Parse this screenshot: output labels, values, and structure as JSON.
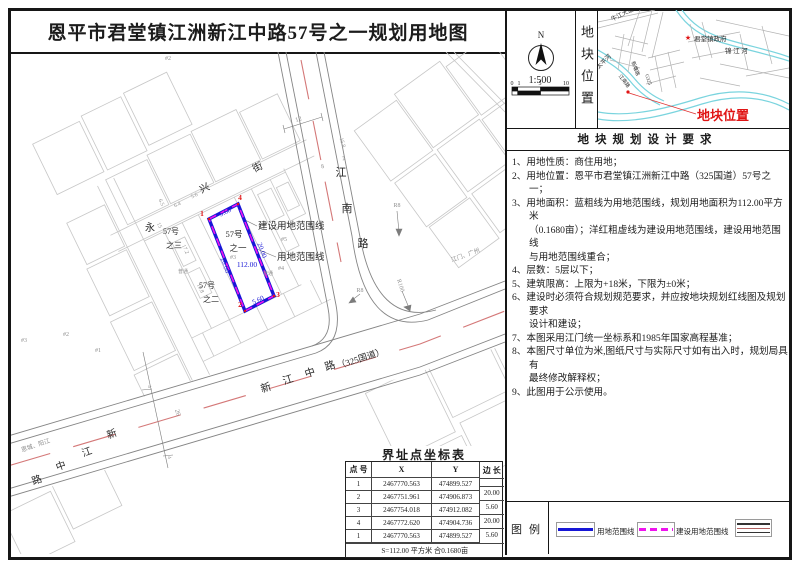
{
  "sheet": {
    "title": "恩平市君堂镇江洲新江中路57号之一规划用地图"
  },
  "compass": {
    "north_label": "N",
    "scale_text": "1:500",
    "scale_ticks": [
      "0",
      "1",
      "5",
      "10"
    ]
  },
  "location_panel": {
    "side_label": "地块位置"
  },
  "requirements": {
    "header": "地块规划设计要求",
    "items": [
      "1、用地性质：商住用地；",
      "2、用地位置：恩平市君堂镇江洲新江中路（325国道）57号之一；",
      "3、用地面积：蓝粗线为用地范围线，规划用地面积为112.00平方米\n（0.1680亩）；洋红粗虚线为建设用地范围线，建设用地范围线\n与用地范围线重合；",
      "4、层数：5层以下；",
      "5、建筑限高：上限为+18米，下限为±0米；",
      "6、建设时必须符合规划规范要求，并应按地块规划红线图及规划要求\n设计和建设；",
      "7、本图采用江门统一坐标系和1985年国家高程基准；",
      "8、本图尺寸单位为米,图纸尺寸与实际尺寸如有出入时，规划局具有\n最终修改解释权；",
      "9、此图用于公示使用。"
    ]
  },
  "legend": {
    "header": "图例",
    "items": [
      {
        "label": "用地范围线"
      },
      {
        "label": "建设用地范围线"
      },
      {
        "label": ""
      }
    ]
  },
  "coord_table": {
    "title": "界址点坐标表",
    "columns": [
      "点 号",
      "X",
      "Y",
      "边 长"
    ],
    "rows": [
      [
        "1",
        "2467770.563",
        "474899.527"
      ],
      [
        "2",
        "2467751.961",
        "474906.873"
      ],
      [
        "3",
        "2467754.018",
        "474912.082"
      ],
      [
        "4",
        "2467772.620",
        "474904.736"
      ],
      [
        "1",
        "2467770.563",
        "474899.527"
      ]
    ],
    "edge_lengths": [
      "20.00",
      "5.60",
      "20.00",
      "5.60"
    ],
    "footer": "S=112.00 平方米 合0.1680亩"
  },
  "colors": {
    "blue": "#1717d6",
    "magenta": "#ee13ee",
    "red": "#e01414",
    "gray": "#8f8f8f",
    "ink": "#2a2a2a",
    "river": "#7ad4de"
  },
  "map": {
    "labels": [
      {
        "t": "兴",
        "x": 206,
        "y": 191,
        "r": -26,
        "s": 10
      },
      {
        "t": "街",
        "x": 259,
        "y": 170,
        "r": -26,
        "s": 10
      },
      {
        "t": "永",
        "x": 150,
        "y": 231,
        "s": 10
      },
      {
        "t": "江",
        "x": 341,
        "y": 176,
        "s": 11
      },
      {
        "t": "南",
        "x": 347,
        "y": 212,
        "s": 11
      },
      {
        "t": "路",
        "x": 363,
        "y": 247,
        "s": 11
      },
      {
        "t": "新",
        "x": 267,
        "y": 391,
        "r": -18,
        "s": 10.5
      },
      {
        "t": "江",
        "x": 289,
        "y": 383,
        "r": -18,
        "s": 10.5
      },
      {
        "t": "中",
        "x": 311,
        "y": 376,
        "r": -18,
        "s": 10.5
      },
      {
        "t": "路",
        "x": 331,
        "y": 369,
        "r": -18,
        "s": 10.5
      },
      {
        "t": "（325国道）",
        "x": 338,
        "y": 369,
        "r": -18,
        "s": 9,
        "a": "start"
      },
      {
        "t": "新",
        "x": 113,
        "y": 437,
        "r": -20,
        "s": 10
      },
      {
        "t": "江",
        "x": 88,
        "y": 455,
        "r": -20,
        "s": 10
      },
      {
        "t": "中",
        "x": 62,
        "y": 469,
        "r": -20,
        "s": 10
      },
      {
        "t": "路",
        "x": 38,
        "y": 483,
        "r": -20,
        "s": 10
      },
      {
        "t": "恩城、阳江",
        "x": 22,
        "y": 452,
        "r": -19,
        "s": 6,
        "a": "start",
        "c": "gray"
      },
      {
        "t": "江门、广州",
        "x": 452,
        "y": 262,
        "r": -20,
        "s": 6,
        "a": "start",
        "c": "gray"
      },
      {
        "t": "R8",
        "x": 397,
        "y": 207,
        "s": 6,
        "c": "gray"
      },
      {
        "t": "R8",
        "x": 360,
        "y": 292,
        "s": 6,
        "c": "gray"
      },
      {
        "t": "R100",
        "x": 399,
        "y": 286,
        "r": 72,
        "s": 6,
        "c": "gray"
      },
      {
        "t": "12",
        "x": 299,
        "y": 121,
        "r": -17,
        "s": 6.5,
        "c": "gray"
      },
      {
        "t": "8",
        "x": 323,
        "y": 168,
        "r": -17,
        "s": 6,
        "c": "gray"
      },
      {
        "t": "2",
        "x": 344,
        "y": 160,
        "r": -17,
        "s": 6,
        "c": "gray"
      },
      {
        "t": "15.8",
        "x": 341,
        "y": 143,
        "r": 73,
        "s": 5.5,
        "c": "gray"
      },
      {
        "t": "26",
        "x": 176,
        "y": 413,
        "r": 73,
        "s": 6.5,
        "c": "gray"
      },
      {
        "t": "4",
        "x": 148,
        "y": 387,
        "r": 73,
        "s": 5,
        "c": "gray"
      },
      {
        "t": "4",
        "x": 168,
        "y": 458,
        "r": 73,
        "s": 5,
        "c": "gray"
      },
      {
        "t": "6.5",
        "x": 160,
        "y": 203,
        "r": 64,
        "s": 5.5,
        "c": "gray"
      },
      {
        "t": "6.4",
        "x": 178,
        "y": 206,
        "r": -26,
        "s": 5.5,
        "c": "gray"
      },
      {
        "t": "5.6",
        "x": 195,
        "y": 197,
        "r": -26,
        "s": 5.5,
        "c": "gray"
      },
      {
        "t": "15",
        "x": 158,
        "y": 226,
        "r": 64,
        "s": 5.5,
        "c": "gray"
      },
      {
        "t": "17.2",
        "x": 184,
        "y": 250,
        "r": 64,
        "s": 5.5,
        "c": "gray"
      },
      {
        "t": "19.8",
        "x": 199,
        "y": 289,
        "r": 64,
        "s": 5.5,
        "c": "gray"
      },
      {
        "t": "#2",
        "x": 168,
        "y": 60,
        "s": 6,
        "c": "gray"
      },
      {
        "t": "#4",
        "x": 262,
        "y": 227,
        "s": 6,
        "c": "gray"
      },
      {
        "t": "#5",
        "x": 284,
        "y": 241,
        "s": 6,
        "c": "gray"
      },
      {
        "t": "#4",
        "x": 281,
        "y": 270,
        "s": 6,
        "c": "gray"
      },
      {
        "t": "#3",
        "x": 233,
        "y": 259,
        "s": 6,
        "c": "gray"
      },
      {
        "t": "#3",
        "x": 24,
        "y": 342,
        "s": 6,
        "c": "gray"
      },
      {
        "t": "#2",
        "x": 66,
        "y": 336,
        "s": 6,
        "c": "gray"
      },
      {
        "t": "#1",
        "x": 98,
        "y": 352,
        "s": 6,
        "c": "gray"
      },
      {
        "t": "普通",
        "x": 183,
        "y": 273,
        "s": 5,
        "c": "gray"
      },
      {
        "t": "普通",
        "x": 268,
        "y": 275,
        "s": 5,
        "c": "gray"
      },
      {
        "t": "57号",
        "x": 234,
        "y": 237,
        "s": 8.5
      },
      {
        "t": "之一",
        "x": 238,
        "y": 251,
        "s": 8.5
      },
      {
        "t": "57号",
        "x": 171,
        "y": 234,
        "s": 8
      },
      {
        "t": "之三",
        "x": 174,
        "y": 248,
        "s": 8
      },
      {
        "t": "57号",
        "x": 207,
        "y": 288,
        "s": 8
      },
      {
        "t": "之二",
        "x": 211,
        "y": 302,
        "s": 8
      },
      {
        "t": "112.00",
        "x": 247,
        "y": 267,
        "s": 7.5,
        "c": "blue"
      },
      {
        "t": "5.60",
        "x": 226,
        "y": 214,
        "r": -26,
        "s": 7,
        "c": "blue"
      },
      {
        "t": "5.60",
        "x": 259,
        "y": 302,
        "r": -26,
        "s": 7,
        "c": "blue"
      },
      {
        "t": "20.00",
        "x": 260,
        "y": 251,
        "r": 70,
        "s": 7,
        "c": "blue"
      },
      {
        "t": "20.00",
        "x": 223,
        "y": 266,
        "r": 70,
        "s": 7,
        "c": "blue"
      },
      {
        "t": "1",
        "x": 202,
        "y": 216,
        "s": 7.5,
        "c": "red",
        "w": 1
      },
      {
        "t": "4",
        "x": 240,
        "y": 200,
        "s": 7.5,
        "c": "red",
        "w": 1
      },
      {
        "t": "2",
        "x": 240,
        "y": 307,
        "s": 7.5,
        "c": "red",
        "w": 1
      },
      {
        "t": "3",
        "x": 278,
        "y": 297,
        "s": 7.5,
        "c": "red",
        "w": 1
      },
      {
        "t": "建设用地范围线",
        "x": 258,
        "y": 229,
        "s": 9.5,
        "a": "start"
      },
      {
        "t": "用地范围线",
        "x": 277,
        "y": 260,
        "s": 9.5,
        "a": "start"
      }
    ]
  },
  "locmap": {
    "labels": [
      {
        "t": "牛江大道",
        "x": 623,
        "y": 16,
        "r": -26,
        "s": 6
      },
      {
        "t": "太平河",
        "x": 605,
        "y": 63,
        "r": -44,
        "s": 6
      },
      {
        "t": "新塘路",
        "x": 634,
        "y": 69,
        "r": 70,
        "s": 5
      },
      {
        "t": "江南路",
        "x": 623,
        "y": 82,
        "r": 52,
        "s": 5
      },
      {
        "t": "G325",
        "x": 647,
        "y": 80,
        "r": 72,
        "s": 5
      },
      {
        "t": "★",
        "x": 688,
        "y": 40,
        "s": 7,
        "c": "red"
      },
      {
        "t": "君堂镇政府",
        "x": 694,
        "y": 41,
        "s": 6.5,
        "a": "start"
      },
      {
        "t": "锦 江 河",
        "x": 725,
        "y": 53,
        "s": 6.5,
        "a": "start"
      },
      {
        "t": "地块位置",
        "x": 697,
        "y": 120,
        "s": 13,
        "a": "start",
        "c": "red",
        "w": 1
      }
    ]
  }
}
